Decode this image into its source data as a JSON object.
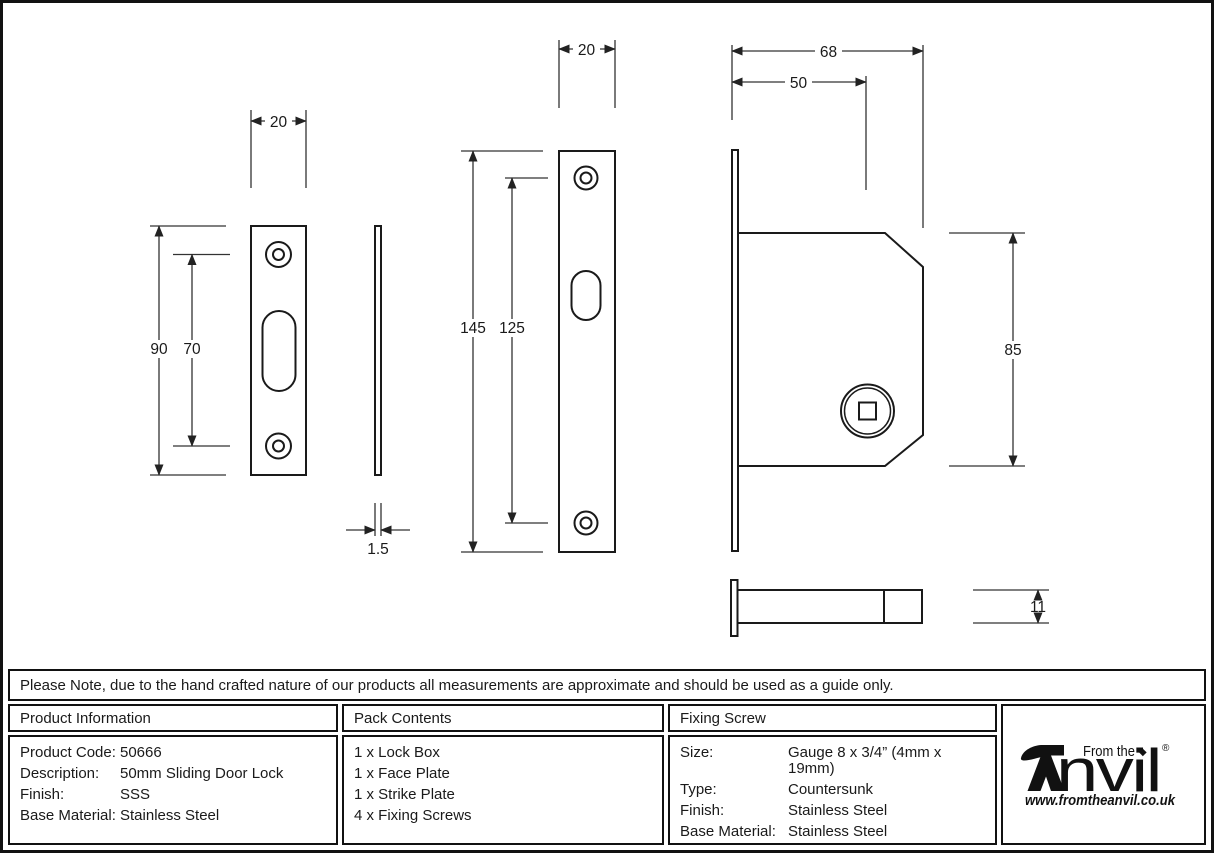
{
  "drawing": {
    "strike_plate": {
      "width_dim": "20",
      "height_dim": "90",
      "hole_spacing_dim": "70",
      "thickness_dim": "1.5"
    },
    "face_plate": {
      "width_dim": "20",
      "height_dim": "145",
      "hole_spacing_dim": "125"
    },
    "lock_box": {
      "depth_dim": "68",
      "backset_dim": "50",
      "height_dim": "85",
      "thickness_dim": "11"
    }
  },
  "note": "Please Note, due to the hand crafted nature of our products all measurements are approximate and should be used as a guide only.",
  "table": {
    "product_information": {
      "title": "Product Information",
      "rows": [
        {
          "label": "Product Code:",
          "value": "50666"
        },
        {
          "label": "Description:",
          "value": "50mm Sliding Door Lock"
        },
        {
          "label": "Finish:",
          "value": "SSS"
        },
        {
          "label": "Base Material:",
          "value": "Stainless Steel"
        }
      ]
    },
    "pack_contents": {
      "title": "Pack Contents",
      "items": [
        "1 x Lock Box",
        "1 x Face Plate",
        "1 x Strike Plate",
        "4 x Fixing Screws"
      ]
    },
    "fixing_screw": {
      "title": "Fixing Screw",
      "rows": [
        {
          "label": "Size:",
          "value": "Gauge 8 x 3/4” (4mm x 19mm)"
        },
        {
          "label": "Type:",
          "value": "Countersunk"
        },
        {
          "label": "Finish:",
          "value": "Stainless Steel"
        },
        {
          "label": "Base Material:",
          "value": "Stainless Steel"
        }
      ]
    }
  },
  "logo": {
    "from_the": "From the",
    "brand": "Anvil",
    "brand_rest": "nvil",
    "diamond": "◆",
    "registered": "®",
    "url": "www.fromtheanvil.co.uk"
  }
}
